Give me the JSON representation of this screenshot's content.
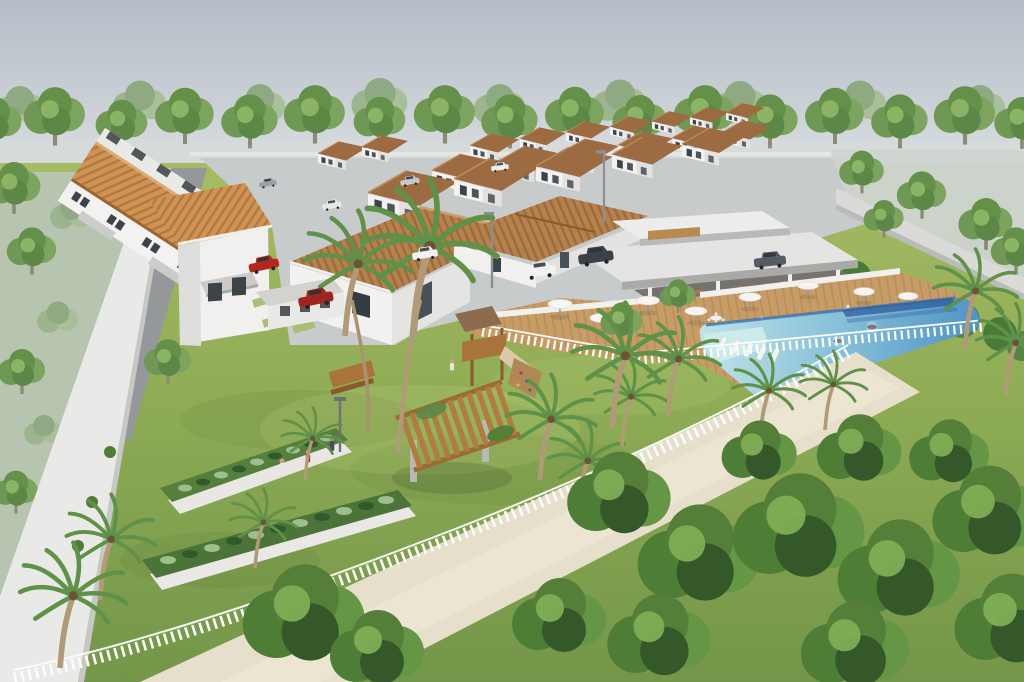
{
  "image": {
    "kind": "3d-architectural-aerial-render",
    "subject": "Aerial render of a gated residential condominium with leisure area",
    "visible_text": "none"
  },
  "scene": {
    "sky": "pale overcast blue-grey sky",
    "background": "continuous tree line behind the development",
    "housing": {
      "left_townhouse_row": {
        "description": "long row of attached two-storey townhouses",
        "roof": "orange clay tile",
        "stories": 2
      },
      "duplex_rows": {
        "count": 4,
        "description": "parallel rows of two-storey duplex houses",
        "roof": "brown tile",
        "stories": 2
      },
      "model_home": {
        "description": "single-storey house with hip clay-tile roof",
        "stories": 1
      }
    },
    "amenities": [
      {
        "name": "clubhouse",
        "description": "flat-roof open pavilion with dining tables"
      },
      {
        "name": "swimming-pool",
        "description": "free-form pool with tanning ledge, in-water loungers and lap lane"
      },
      {
        "name": "sun-deck",
        "description": "timber deck with white umbrellas and tables"
      },
      {
        "name": "playground",
        "description": "timber play tower with slide and climbing wall"
      },
      {
        "name": "community-garden",
        "description": "two long raised planter beds"
      },
      {
        "name": "pergola",
        "description": "timber slat pergola on concrete posts"
      }
    ],
    "boundaries": [
      "white perimeter wall",
      "white picket fence",
      "sand walking path",
      "grey rear service alley"
    ],
    "vegetation": [
      "background tree line",
      "lawns",
      "palm trees",
      "dense foreground trees",
      "shrub planting under walls"
    ],
    "vehicles": {
      "parked_cars": 10,
      "colors": [
        "red",
        "white",
        "dark-grey",
        "silver"
      ]
    },
    "people_count": 6,
    "umbrella_count": 8,
    "street_lamps": 3
  },
  "palette": {
    "sky_top": "#b4bdc7",
    "sky_horizon": "#dfe2e3",
    "treeline_green": "#6f9854",
    "grass": "#a3ba62",
    "grass_dark": "#74964a",
    "roof_orange": "#cf9455",
    "roof_brown": "#9c6b42",
    "wall_white": "#f2f1ef",
    "pavement": "#c8cbcc",
    "alley_grey": "#94989a",
    "pool_shallow": "#bfe3e7",
    "pool_deep": "#4f92c4",
    "pool_lane": "#2d5e9b",
    "wood_deck": "#c79c66",
    "sand_path": "#e6dfcb",
    "fence_white": "#fcfcfb",
    "perimeter_wall": "#e9eae8",
    "car_red": "#b3271f",
    "foliage_dark": "#4e7d36",
    "palm_green": "#5f9148"
  }
}
